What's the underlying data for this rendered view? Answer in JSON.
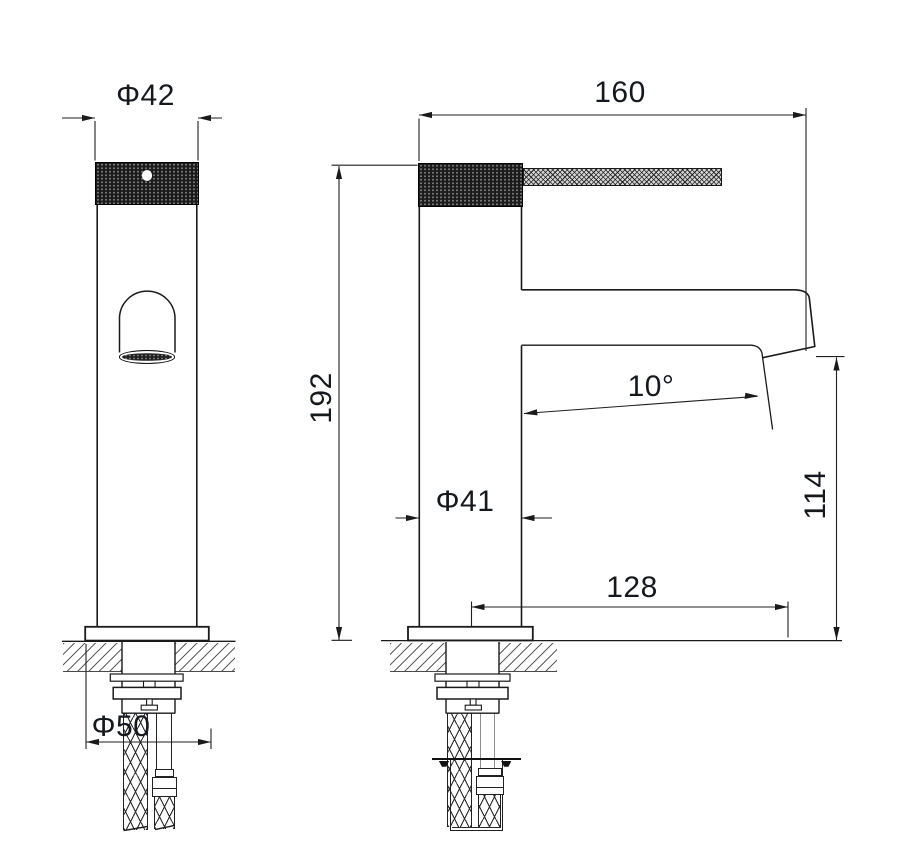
{
  "drawing": {
    "background": "#ffffff",
    "colors": {
      "line": "#1a1a1a",
      "hatch": "#5d5d5d",
      "knurl": "#1b1b1b",
      "lever_fill": "#d2d2d2"
    },
    "dimensions": {
      "handle_width": {
        "label": "Φ42"
      },
      "spout_reach": {
        "label": "160"
      },
      "overall_height": {
        "label": "192"
      },
      "body_diameter": {
        "label": "Φ41"
      },
      "spout_angle": {
        "label": "10°"
      },
      "spout_height": {
        "label": "114"
      },
      "spout_offset": {
        "label": "128"
      },
      "base_diameter": {
        "label": "Φ50"
      }
    }
  }
}
